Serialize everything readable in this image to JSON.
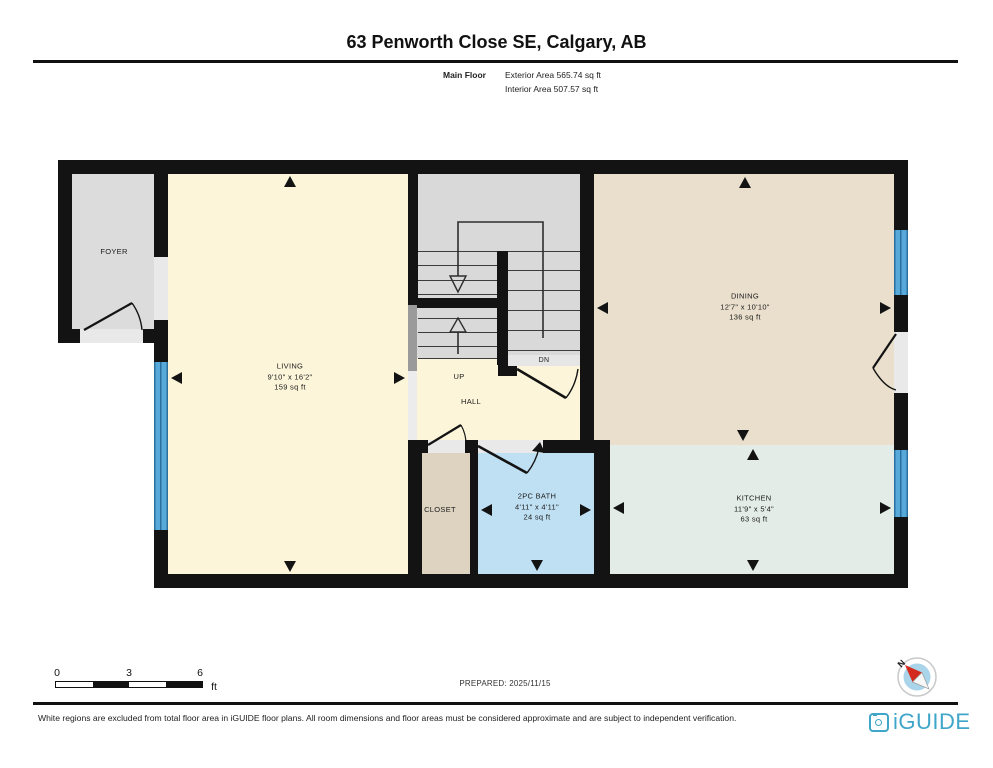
{
  "header": {
    "title": "63 Penworth Close SE, Calgary, AB",
    "floor_label": "Main Floor",
    "exterior_area": "Exterior Area 565.74 sq ft",
    "interior_area": "Interior Area 507.57 sq ft"
  },
  "rooms": {
    "foyer": {
      "name": "FOYER"
    },
    "living": {
      "name": "LIVING",
      "dims": "9'10\" x 16'2\"",
      "area": "159 sq ft"
    },
    "dining": {
      "name": "DINING",
      "dims": "12'7\" x 10'10\"",
      "area": "136 sq ft"
    },
    "kitchen": {
      "name": "KITCHEN",
      "dims": "11'9\" x 5'4\"",
      "area": "63 sq ft"
    },
    "bath": {
      "name": "2PC BATH",
      "dims": "4'11\" x 4'11\"",
      "area": "24 sq ft"
    },
    "closet": {
      "name": "CLOSET"
    },
    "hall": {
      "name": "HALL"
    },
    "stairs": {
      "up": "UP",
      "down": "DN"
    }
  },
  "scale_bar": {
    "tick0": "0",
    "tick1": "3",
    "tick2": "6",
    "unit": "ft"
  },
  "compass": {
    "north_label": "N"
  },
  "footer": {
    "prepared": "PREPARED: 2025/11/15",
    "disclaimer": "White regions are excluded from total floor area in iGUIDE floor plans. All room dimensions and floor areas must be considered approximate and are subject to independent verification.",
    "brand": "iGUIDE"
  },
  "colors": {
    "wall": "#131313",
    "window_blue": "#57a9d9",
    "living_cream": "#fcf5da",
    "dining_tan": "#e9dfcc",
    "kitchen_green": "#e3ece6",
    "bath_blue": "#bfe0f3",
    "closet_tan": "#ddd3c0",
    "foyer_gray": "#dcdcdc",
    "stair_gray": "#d9d9d9",
    "brand_cyan": "#3fa5c9",
    "compass_red": "#d42a1e"
  }
}
